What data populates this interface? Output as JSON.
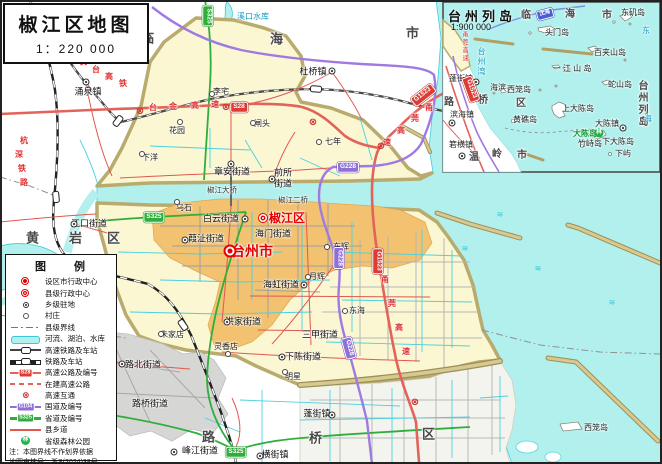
{
  "title_box": {
    "title": "椒江区地图",
    "scale": "1：220 000"
  },
  "inset": {
    "title": "台州列岛",
    "scale": "1:900 000"
  },
  "legend": {
    "title": "图　　例",
    "items": [
      {
        "icon": "city",
        "label": "设区市行政中心"
      },
      {
        "icon": "county",
        "label": "县级行政中心"
      },
      {
        "icon": "town",
        "label": "乡级驻地"
      },
      {
        "icon": "village",
        "label": "村庄"
      },
      {
        "icon": "boundary",
        "label": "县级界线"
      },
      {
        "icon": "river",
        "label": "河流、湖泊、水库"
      },
      {
        "icon": "hsr",
        "label": "高速铁路及车站"
      },
      {
        "icon": "rail",
        "label": "铁路及车站"
      },
      {
        "icon": "expwy",
        "label": "高速公路及编号",
        "badge": "S28"
      },
      {
        "icon": "constr",
        "label": "在建高速公路"
      },
      {
        "icon": "interchange",
        "label": "高速互通"
      },
      {
        "icon": "national",
        "label": "国道及编号",
        "badge": "G104"
      },
      {
        "icon": "provincial",
        "label": "省道及编号",
        "badge": "S325"
      },
      {
        "icon": "countyroad",
        "label": "县乡道"
      },
      {
        "icon": "forest",
        "label": "省级森林公园"
      }
    ],
    "note1": "注：本图界线不作划界依据",
    "note2": "地图审核号：浙S(2024)38号"
  },
  "map_items": [
    {
      "t": "临",
      "x": 148,
      "y": 38,
      "c": "region",
      "n": "region-linhai-char"
    },
    {
      "t": "海",
      "x": 277,
      "y": 39,
      "c": "region",
      "n": "region-linhai-char"
    },
    {
      "t": "市",
      "x": 413,
      "y": 33,
      "c": "region",
      "n": "region-linhai-char"
    },
    {
      "t": "黄",
      "x": 33,
      "y": 238,
      "c": "region",
      "n": "region-huangyan-char"
    },
    {
      "t": "岩",
      "x": 76,
      "y": 238,
      "c": "region",
      "n": "region-huangyan-char"
    },
    {
      "t": "区",
      "x": 114,
      "y": 238,
      "c": "region",
      "n": "region-huangyan-char"
    },
    {
      "t": "路",
      "x": 209,
      "y": 437,
      "c": "region",
      "n": "region-luqiao-char"
    },
    {
      "t": "桥",
      "x": 316,
      "y": 438,
      "c": "region",
      "n": "region-luqiao-char"
    },
    {
      "t": "区",
      "x": 429,
      "y": 434,
      "c": "region",
      "n": "region-luqiao-char"
    },
    {
      "t": "台州市",
      "x": 252,
      "y": 251,
      "c": "city",
      "n": "label-taizhou-city"
    },
    {
      "x": 230,
      "y": 251,
      "c": "sym-city",
      "n": "city-admin-symbol"
    },
    {
      "t": "椒江区",
      "x": 287,
      "y": 218,
      "c": "district",
      "n": "label-jiaojiang-district"
    },
    {
      "x": 263,
      "y": 218,
      "c": "sym-county",
      "n": "county-admin-symbol"
    },
    {
      "t": "涌泉镇",
      "x": 88,
      "y": 92,
      "c": "town",
      "n": "label-yongquan-town"
    },
    {
      "x": 86,
      "y": 82,
      "c": "sym-town"
    },
    {
      "t": "杜桥镇",
      "x": 313,
      "y": 72,
      "c": "town",
      "n": "label-duqiao-town"
    },
    {
      "x": 332,
      "y": 71,
      "c": "sym-town"
    },
    {
      "t": "章安街道",
      "x": 232,
      "y": 172,
      "c": "town",
      "n": "label-zhangan-subdistrict"
    },
    {
      "x": 231,
      "y": 164,
      "c": "sym-town"
    },
    {
      "t": "前所",
      "x": 283,
      "y": 173,
      "c": "town",
      "n": "label-qiansuo-subdistrict"
    },
    {
      "t": "街道",
      "x": 283,
      "y": 184,
      "c": "town"
    },
    {
      "x": 272,
      "y": 179,
      "c": "sym-town"
    },
    {
      "t": "白云街道",
      "x": 221,
      "y": 219,
      "c": "town",
      "n": "label-baiyun-subdistrict"
    },
    {
      "x": 245,
      "y": 219,
      "c": "sym-town"
    },
    {
      "t": "海门街道",
      "x": 273,
      "y": 234,
      "c": "town",
      "n": "label-haimen-subdistrict"
    },
    {
      "t": "葭沚街道",
      "x": 206,
      "y": 239,
      "c": "town",
      "n": "label-jiazhi-subdistrict"
    },
    {
      "x": 185,
      "y": 240,
      "c": "sym-town"
    },
    {
      "t": "江口街道",
      "x": 89,
      "y": 224,
      "c": "town",
      "n": "label-jiangkou-subdistrict"
    },
    {
      "x": 74,
      "y": 224,
      "c": "sym-town"
    },
    {
      "t": "洪家街道",
      "x": 243,
      "y": 322,
      "c": "town",
      "n": "label-hongjia-subdistrict"
    },
    {
      "x": 227,
      "y": 322,
      "c": "sym-town"
    },
    {
      "t": "海虹街道",
      "x": 281,
      "y": 285,
      "c": "town",
      "n": "label-haihong-subdistrict"
    },
    {
      "x": 304,
      "y": 285,
      "c": "sym-town"
    },
    {
      "t": "三甲街道",
      "x": 320,
      "y": 335,
      "c": "town",
      "n": "label-sanjia-subdistrict"
    },
    {
      "t": "下陈街道",
      "x": 303,
      "y": 357,
      "c": "town",
      "n": "label-xiachen-subdistrict"
    },
    {
      "x": 282,
      "y": 357,
      "c": "sym-town"
    },
    {
      "t": "路北街道",
      "x": 143,
      "y": 365,
      "c": "town",
      "n": "label-lubei-subdistrict"
    },
    {
      "x": 122,
      "y": 364,
      "c": "sym-town"
    },
    {
      "t": "路桥街道",
      "x": 150,
      "y": 404,
      "c": "town",
      "n": "label-luqiao-subdistrict"
    },
    {
      "t": "峰江街道",
      "x": 200,
      "y": 451,
      "c": "town",
      "n": "label-fengjiang-subdistrict"
    },
    {
      "x": 174,
      "y": 452,
      "c": "sym-town"
    },
    {
      "t": "横街镇",
      "x": 275,
      "y": 455,
      "c": "town",
      "n": "label-hengjie-town"
    },
    {
      "x": 260,
      "y": 456,
      "c": "sym-town"
    },
    {
      "t": "蓬街镇",
      "x": 317,
      "y": 414,
      "c": "town",
      "n": "label-pengjie-town"
    },
    {
      "x": 332,
      "y": 415,
      "c": "sym-town"
    },
    {
      "t": "李宅",
      "x": 221,
      "y": 92,
      "c": "village"
    },
    {
      "x": 212,
      "y": 94,
      "c": "sym-vill"
    },
    {
      "t": "花园",
      "x": 177,
      "y": 131,
      "c": "village"
    },
    {
      "x": 180,
      "y": 122,
      "c": "sym-vill"
    },
    {
      "t": "闸头",
      "x": 262,
      "y": 124,
      "c": "village"
    },
    {
      "x": 253,
      "y": 123,
      "c": "sym-vill"
    },
    {
      "t": "七年",
      "x": 333,
      "y": 142,
      "c": "village"
    },
    {
      "x": 319,
      "y": 142,
      "c": "sym-vill"
    },
    {
      "t": "下洋",
      "x": 150,
      "y": 158,
      "c": "village"
    },
    {
      "x": 142,
      "y": 154,
      "c": "sym-vill"
    },
    {
      "t": "乌石",
      "x": 184,
      "y": 208,
      "c": "village"
    },
    {
      "x": 177,
      "y": 202,
      "c": "sym-vill"
    },
    {
      "t": "朱家店",
      "x": 172,
      "y": 335,
      "c": "village"
    },
    {
      "x": 161,
      "y": 334,
      "c": "sym-vill"
    },
    {
      "t": "灵香店",
      "x": 226,
      "y": 347,
      "c": "village"
    },
    {
      "x": 228,
      "y": 354,
      "c": "sym-vill"
    },
    {
      "t": "明星",
      "x": 293,
      "y": 377,
      "c": "village"
    },
    {
      "x": 285,
      "y": 372,
      "c": "sym-vill"
    },
    {
      "t": "东辉",
      "x": 341,
      "y": 247,
      "c": "village"
    },
    {
      "x": 327,
      "y": 247,
      "c": "sym-vill"
    },
    {
      "t": "月辉",
      "x": 317,
      "y": 277,
      "c": "village"
    },
    {
      "x": 308,
      "y": 277,
      "c": "sym-vill"
    },
    {
      "t": "东海",
      "x": 357,
      "y": 311,
      "c": "village"
    },
    {
      "x": 345,
      "y": 311,
      "c": "sym-vill"
    },
    {
      "t": "溪口水库",
      "x": 253,
      "y": 17,
      "c": "water",
      "n": "label-xikou-reservoir"
    },
    {
      "t": "椒江大桥",
      "x": 222,
      "y": 190,
      "c": "bridge",
      "n": "label-jiaojiang-bridge"
    },
    {
      "t": "椒江二桥",
      "x": 293,
      "y": 200,
      "c": "bridge",
      "n": "label-jiaojiang-second-bridge"
    },
    {
      "t": "西笼岛",
      "x": 596,
      "y": 428,
      "c": "island",
      "n": "label-xilong-island"
    },
    {
      "t": "杭",
      "x": 83,
      "y": 62,
      "c": "roadname"
    },
    {
      "t": "台",
      "x": 96,
      "y": 70,
      "c": "roadname"
    },
    {
      "t": "高",
      "x": 109,
      "y": 77,
      "c": "roadname"
    },
    {
      "t": "铁",
      "x": 123,
      "y": 84,
      "c": "roadname"
    },
    {
      "t": "杭",
      "x": 24,
      "y": 141,
      "c": "roadname"
    },
    {
      "t": "深",
      "x": 19,
      "y": 155,
      "c": "roadname"
    },
    {
      "t": "铁",
      "x": 22,
      "y": 169,
      "c": "roadname"
    },
    {
      "t": "路",
      "x": 24,
      "y": 183,
      "c": "roadname"
    },
    {
      "t": "台",
      "x": 153,
      "y": 108,
      "c": "roadname"
    },
    {
      "t": "金",
      "x": 173,
      "y": 107,
      "c": "roadname"
    },
    {
      "t": "高",
      "x": 195,
      "y": 106,
      "c": "roadname"
    },
    {
      "t": "速",
      "x": 215,
      "y": 105,
      "c": "roadname"
    },
    {
      "t": "甬",
      "x": 429,
      "y": 108,
      "c": "roadname"
    },
    {
      "t": "莞",
      "x": 415,
      "y": 119,
      "c": "roadname"
    },
    {
      "t": "高",
      "x": 401,
      "y": 131,
      "c": "roadname"
    },
    {
      "t": "速",
      "x": 387,
      "y": 143,
      "c": "roadname"
    },
    {
      "t": "甬",
      "x": 385,
      "y": 280,
      "c": "roadname"
    },
    {
      "t": "莞",
      "x": 392,
      "y": 304,
      "c": "roadname"
    },
    {
      "t": "高",
      "x": 399,
      "y": 328,
      "c": "roadname"
    },
    {
      "t": "速",
      "x": 406,
      "y": 352,
      "c": "roadname"
    },
    {
      "t": "S28",
      "x": 239,
      "y": 107,
      "c": "badge badge-exp",
      "n": "badge-s28"
    },
    {
      "t": "G1523",
      "x": 423,
      "y": 95,
      "c": "badge badge-exp",
      "r": -38,
      "n": "badge-g1523"
    },
    {
      "t": "G1523",
      "x": 378,
      "y": 261,
      "c": "badge badge-exp",
      "r": 90,
      "n": "badge-g1523"
    },
    {
      "t": "G228",
      "x": 348,
      "y": 167,
      "c": "badge badge-nat",
      "n": "badge-g228"
    },
    {
      "t": "G228",
      "x": 339,
      "y": 258,
      "c": "badge badge-nat",
      "r": 90,
      "n": "badge-g228"
    },
    {
      "t": "G228",
      "x": 349,
      "y": 348,
      "c": "badge badge-nat",
      "r": 75,
      "n": "badge-g228"
    },
    {
      "t": "S325",
      "x": 236,
      "y": 452,
      "c": "badge badge-prov",
      "n": "badge-s325"
    },
    {
      "t": "S325",
      "x": 154,
      "y": 217,
      "c": "badge badge-prov",
      "n": "badge-s325"
    },
    {
      "t": "S325",
      "x": 208,
      "y": 16,
      "c": "badge badge-prov",
      "r": 90,
      "n": "badge-s325"
    },
    {
      "t": "⊗",
      "x": 140,
      "y": 112,
      "c": "sym-ix",
      "n": "interchange-symbol"
    },
    {
      "t": "⊗",
      "x": 226,
      "y": 108,
      "c": "sym-ix",
      "n": "interchange-symbol"
    },
    {
      "t": "⊗",
      "x": 313,
      "y": 123,
      "c": "sym-ix",
      "n": "interchange-symbol"
    },
    {
      "t": "⊗",
      "x": 381,
      "y": 147,
      "c": "sym-ix",
      "n": "interchange-symbol"
    },
    {
      "t": "⊗",
      "x": 415,
      "y": 403,
      "c": "sym-ix",
      "n": "interchange-symbol"
    },
    {
      "x": 56,
      "y": 197,
      "c": "station",
      "r": 85,
      "n": "rail-station-symbol"
    },
    {
      "x": 183,
      "y": 325,
      "c": "station",
      "r": 55,
      "n": "rail-station-symbol"
    },
    {
      "x": 118,
      "y": 121,
      "c": "station",
      "r": -52,
      "n": "rail-station-symbol"
    },
    {
      "x": 316,
      "y": 89,
      "c": "station",
      "r": 4,
      "n": "rail-station-symbol"
    },
    {
      "t": "≋",
      "x": 465,
      "y": 249,
      "c": "wave"
    },
    {
      "t": "≋",
      "x": 538,
      "y": 269,
      "c": "wave"
    },
    {
      "t": "≋",
      "x": 612,
      "y": 303,
      "c": "wave"
    },
    {
      "t": "≋",
      "x": 500,
      "y": 215,
      "c": "wave"
    },
    {
      "t": "临",
      "x": 526,
      "y": 16,
      "c": "region-sm"
    },
    {
      "t": "海",
      "x": 570,
      "y": 15,
      "c": "region-sm"
    },
    {
      "t": "市",
      "x": 607,
      "y": 16,
      "c": "region-sm"
    },
    {
      "t": "东矶岛",
      "x": 633,
      "y": 13,
      "c": "island"
    },
    {
      "t": "头门岛",
      "x": 557,
      "y": 33,
      "c": "island"
    },
    {
      "t": "百夹山岛",
      "x": 610,
      "y": 53,
      "c": "island"
    },
    {
      "t": "一 江 山 岛",
      "x": 572,
      "y": 69,
      "c": "island"
    },
    {
      "t": "台州列岛",
      "x": 641,
      "y": 104,
      "c": "vert region-sm",
      "n": "label-taizhou-liedao"
    },
    {
      "t": "蛇山岛",
      "x": 620,
      "y": 85,
      "c": "island"
    },
    {
      "t": "上大陈岛",
      "x": 578,
      "y": 109,
      "c": "island"
    },
    {
      "t": "大陈镇",
      "x": 607,
      "y": 124,
      "c": "island",
      "n": "label-dachen-town"
    },
    {
      "x": 623,
      "y": 128,
      "c": "sym-town"
    },
    {
      "t": "大陈岛",
      "x": 585,
      "y": 134,
      "c": "forest-label",
      "n": "label-dachen-island"
    },
    {
      "t": "林",
      "x": 599,
      "y": 133,
      "c": "sym-forest",
      "n": "forest-park-icon"
    },
    {
      "t": "竹峙岛",
      "x": 590,
      "y": 144,
      "c": "island"
    },
    {
      "t": "下大陈岛",
      "x": 618,
      "y": 142,
      "c": "island"
    },
    {
      "t": "下屿",
      "x": 623,
      "y": 154,
      "c": "island"
    },
    {
      "t": "西笼岛",
      "x": 519,
      "y": 90,
      "c": "island"
    },
    {
      "t": "海滨",
      "x": 498,
      "y": 88,
      "c": "island"
    },
    {
      "t": "黄礁岛",
      "x": 525,
      "y": 120,
      "c": "island"
    },
    {
      "t": "蓬街镇",
      "x": 461,
      "y": 79,
      "c": "island"
    },
    {
      "x": 476,
      "y": 82,
      "c": "sym-town"
    },
    {
      "t": "滨海镇",
      "x": 462,
      "y": 115,
      "c": "island"
    },
    {
      "x": 452,
      "y": 123,
      "c": "sym-town"
    },
    {
      "t": "箬横镇",
      "x": 461,
      "y": 145,
      "c": "island"
    },
    {
      "x": 462,
      "y": 156,
      "c": "sym-town"
    },
    {
      "t": "温",
      "x": 474,
      "y": 158,
      "c": "region-sm"
    },
    {
      "t": "岭",
      "x": 497,
      "y": 155,
      "c": "region-sm"
    },
    {
      "t": "市",
      "x": 522,
      "y": 156,
      "c": "region-sm"
    },
    {
      "t": "路",
      "x": 449,
      "y": 103,
      "c": "region-sm"
    },
    {
      "t": "桥",
      "x": 483,
      "y": 101,
      "c": "region-sm"
    },
    {
      "t": "区",
      "x": 521,
      "y": 104,
      "c": "region-sm"
    },
    {
      "t": "甬莞高速",
      "x": 464,
      "y": 47,
      "c": "vert roadname-sm"
    },
    {
      "t": "台州湾",
      "x": 481,
      "y": 62,
      "c": "vert water"
    },
    {
      "t": "东",
      "x": 646,
      "y": 31,
      "c": "water"
    },
    {
      "t": "海",
      "x": 648,
      "y": 119,
      "c": "water"
    },
    {
      "t": "沈海",
      "x": 545,
      "y": 14,
      "c": "badge badge-shen",
      "r": -15,
      "n": "badge-shenhai"
    },
    {
      "t": "G1523",
      "x": 471,
      "y": 89,
      "c": "badge badge-exp",
      "r": 70,
      "n": "badge-g1523"
    }
  ]
}
